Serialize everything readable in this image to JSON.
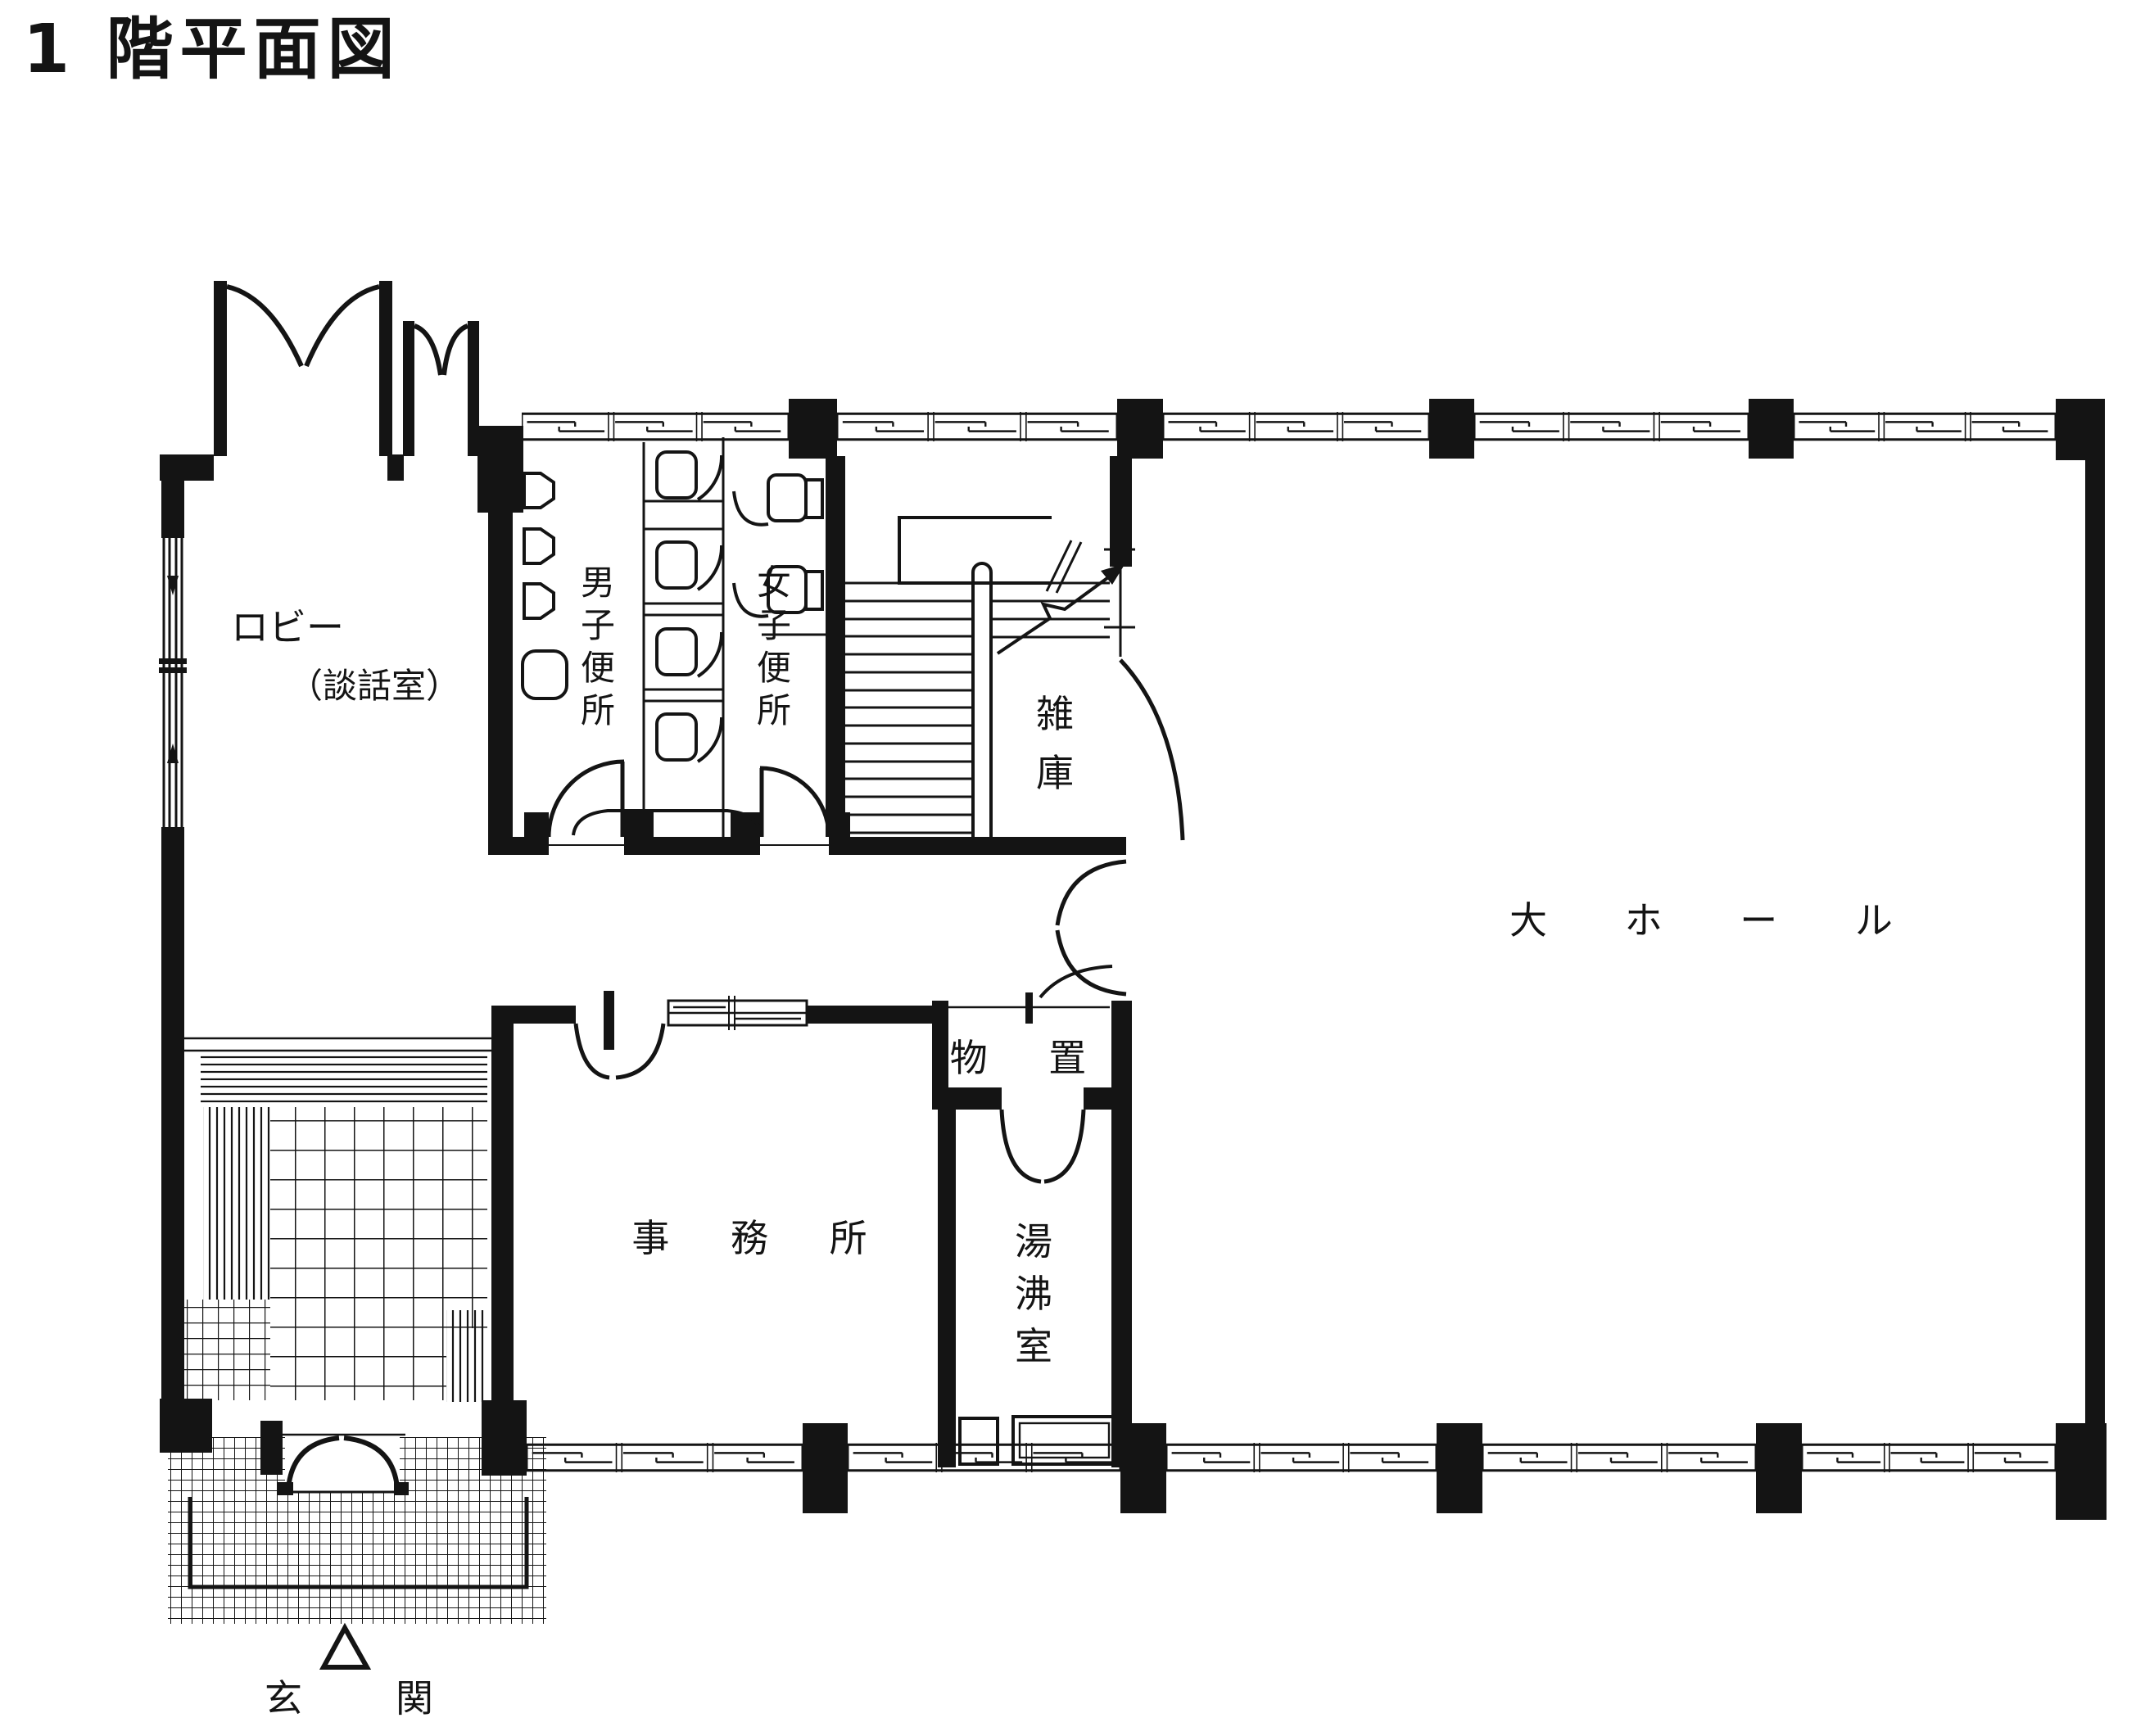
{
  "title": "1 階平面図",
  "colors": {
    "ink": "#141414",
    "paper": "#ffffff"
  },
  "rooms": {
    "lobby": {
      "line1": "ロビー",
      "line2": "（談話室）"
    },
    "mens_toilet": {
      "chars": [
        "男",
        "子",
        "便",
        "所"
      ]
    },
    "womens_toilet": {
      "chars": [
        "女",
        "子",
        "便",
        "所"
      ]
    },
    "misc_storage": {
      "chars": [
        "雑",
        "庫"
      ]
    },
    "large_hall": {
      "label": "大 ホ ー ル"
    },
    "storeroom": {
      "label": "物 置"
    },
    "office": {
      "label": "事 務 所"
    },
    "hot_water_room": {
      "chars": [
        "湯",
        "沸",
        "室"
      ]
    },
    "entrance": {
      "char_left": "玄",
      "char_right": "関"
    }
  }
}
